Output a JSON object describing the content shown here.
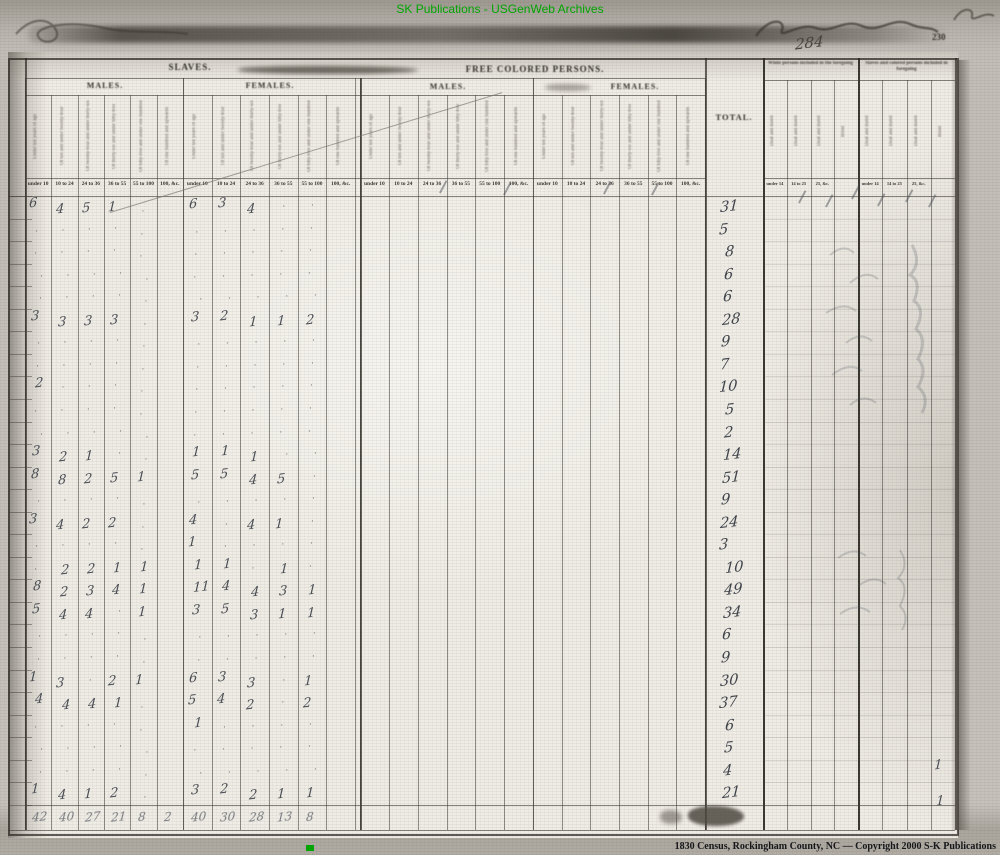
{
  "overlay": {
    "top_banner": "SK Publications - USGenWeb Archives",
    "bottom_credit": "1830 Census, Rockingham County, NC  —  Copyright 2000 S-K Publications",
    "accent_green": "#00a800",
    "ink_color": "#4a4e55"
  },
  "page": {
    "printed_page_number": "230",
    "handwritten_number": "284"
  },
  "form_header": {
    "sections": [
      {
        "title": "SLAVES.",
        "groups": [
          {
            "label": "MALES."
          },
          {
            "label": "FEMALES."
          }
        ]
      },
      {
        "title": "FREE COLORED PERSONS.",
        "groups": [
          {
            "label": "MALES."
          },
          {
            "label": "FEMALES."
          }
        ]
      }
    ],
    "age_column_labels": [
      "Under ten years of age",
      "Of ten and under twenty-four",
      "Of twenty-four and under thirty-six",
      "Of thirty-six and under fifty-five",
      "Of fifty-five and under one hundred",
      "Of one hundred and upwards"
    ],
    "age_strip": [
      "under 10",
      "10 to 24",
      "24 to 36",
      "36 to 55",
      "55 to 100",
      "100, &c."
    ],
    "total_label": "TOTAL.",
    "right_sections": [
      {
        "title": "White persons included in the foregoing",
        "strip": [
          "under 14",
          "14 to 25",
          "25, &c."
        ],
        "columns": [
          "Deaf and dumb",
          "Deaf and dumb",
          "Deaf and dumb",
          "Blind"
        ]
      },
      {
        "title": "Slaves and colored persons included in foregoing",
        "strip": [
          "under 14",
          "14 to 25",
          "25, &c."
        ],
        "columns": [
          "Deaf and dumb",
          "Deaf and dumb",
          "Deaf and dumb",
          "Blind"
        ]
      }
    ]
  },
  "table": {
    "rows": [
      {
        "m": [
          "6",
          "4",
          "5",
          "1",
          "",
          ""
        ],
        "f": [
          "6",
          "3",
          "4",
          "",
          "",
          ""
        ],
        "total": "31"
      },
      {
        "m": [
          "",
          "",
          "",
          "",
          "",
          ""
        ],
        "f": [
          "",
          "",
          "",
          "",
          "",
          ""
        ],
        "total": "5"
      },
      {
        "m": [
          "",
          "",
          "",
          "",
          "",
          ""
        ],
        "f": [
          "",
          "",
          "",
          "",
          "",
          ""
        ],
        "total": "8"
      },
      {
        "m": [
          "",
          "",
          "",
          "",
          "",
          ""
        ],
        "f": [
          "",
          "",
          "",
          "",
          "",
          ""
        ],
        "total": "6"
      },
      {
        "m": [
          "",
          "",
          "",
          "",
          "",
          ""
        ],
        "f": [
          "",
          "",
          "",
          "",
          "",
          ""
        ],
        "total": "6"
      },
      {
        "m": [
          "3",
          "3",
          "3",
          "3",
          "",
          ""
        ],
        "f": [
          "3",
          "2",
          "1",
          "1",
          "2",
          ""
        ],
        "total": "28"
      },
      {
        "m": [
          "",
          "",
          "",
          "",
          "",
          ""
        ],
        "f": [
          "",
          "",
          "",
          "",
          "",
          ""
        ],
        "total": "9"
      },
      {
        "m": [
          "",
          "",
          "",
          "",
          "",
          ""
        ],
        "f": [
          "",
          "",
          "",
          "",
          "",
          ""
        ],
        "total": "7"
      },
      {
        "m": [
          "2",
          "",
          "",
          "",
          "",
          ""
        ],
        "f": [
          "",
          "",
          "",
          "",
          "",
          ""
        ],
        "total": "10"
      },
      {
        "m": [
          "",
          "",
          "",
          "",
          "",
          ""
        ],
        "f": [
          "",
          "",
          "",
          "",
          "",
          ""
        ],
        "total": "5"
      },
      {
        "m": [
          "",
          "",
          "",
          "",
          "",
          ""
        ],
        "f": [
          "",
          "",
          "",
          "",
          "",
          ""
        ],
        "total": "2"
      },
      {
        "m": [
          "3",
          "2",
          "1",
          "",
          "",
          ""
        ],
        "f": [
          "1",
          "1",
          "1",
          "",
          "",
          ""
        ],
        "total": "14"
      },
      {
        "m": [
          "8",
          "8",
          "2",
          "5",
          "1",
          ""
        ],
        "f": [
          "5",
          "5",
          "4",
          "5",
          "",
          ""
        ],
        "total": "51"
      },
      {
        "m": [
          "",
          "",
          "",
          "",
          "",
          ""
        ],
        "f": [
          "",
          "",
          "",
          "",
          "",
          ""
        ],
        "total": "9"
      },
      {
        "m": [
          "3",
          "4",
          "2",
          "2",
          "",
          ""
        ],
        "f": [
          "4",
          "",
          "4",
          "1",
          "",
          ""
        ],
        "total": "24"
      },
      {
        "m": [
          "",
          "",
          "",
          "",
          "",
          ""
        ],
        "f": [
          "1",
          "",
          "",
          "",
          "",
          ""
        ],
        "total": "3"
      },
      {
        "m": [
          "",
          "2",
          "2",
          "1",
          "1",
          ""
        ],
        "f": [
          "1",
          "1",
          "",
          "1",
          "",
          ""
        ],
        "total": "10"
      },
      {
        "m": [
          "8",
          "2",
          "3",
          "4",
          "1",
          ""
        ],
        "f": [
          "11",
          "4",
          "4",
          "3",
          "1",
          ""
        ],
        "total": "49"
      },
      {
        "m": [
          "5",
          "4",
          "4",
          "",
          "1",
          ""
        ],
        "f": [
          "3",
          "5",
          "3",
          "1",
          "1",
          ""
        ],
        "total": "34"
      },
      {
        "m": [
          "",
          "",
          "",
          "",
          "",
          ""
        ],
        "f": [
          "",
          "",
          "",
          "",
          "",
          ""
        ],
        "total": "6"
      },
      {
        "m": [
          "",
          "",
          "",
          "",
          "",
          ""
        ],
        "f": [
          "",
          "",
          "",
          "",
          "",
          ""
        ],
        "total": "9"
      },
      {
        "m": [
          "1",
          "3",
          "",
          "2",
          "1",
          ""
        ],
        "f": [
          "6",
          "3",
          "3",
          "",
          "1",
          ""
        ],
        "total": "30"
      },
      {
        "m": [
          "4",
          "4",
          "4",
          "1",
          "",
          ""
        ],
        "f": [
          "5",
          "4",
          "2",
          "",
          "2",
          ""
        ],
        "total": "37"
      },
      {
        "m": [
          "",
          "",
          "",
          "",
          "",
          ""
        ],
        "f": [
          "1",
          "",
          "",
          "",
          "",
          ""
        ],
        "total": "6"
      },
      {
        "m": [
          "",
          "",
          "",
          "",
          "",
          ""
        ],
        "f": [
          "",
          "",
          "",
          "",
          "",
          ""
        ],
        "total": "5"
      },
      {
        "m": [
          "",
          "",
          "",
          "",
          "",
          ""
        ],
        "f": [
          "",
          "",
          "",
          "",
          "",
          ""
        ],
        "total": "4"
      },
      {
        "m": [
          "1",
          "4",
          "1",
          "2",
          "",
          ""
        ],
        "f": [
          "3",
          "2",
          "2",
          "1",
          "1",
          ""
        ],
        "total": "21"
      }
    ],
    "column_tallies": {
      "males": [
        "42",
        "40",
        "27",
        "21",
        "8",
        "2"
      ],
      "females": [
        "40",
        "30",
        "28",
        "13",
        "8",
        ""
      ]
    },
    "right_margin_marks": [
      "1",
      "1"
    ]
  }
}
